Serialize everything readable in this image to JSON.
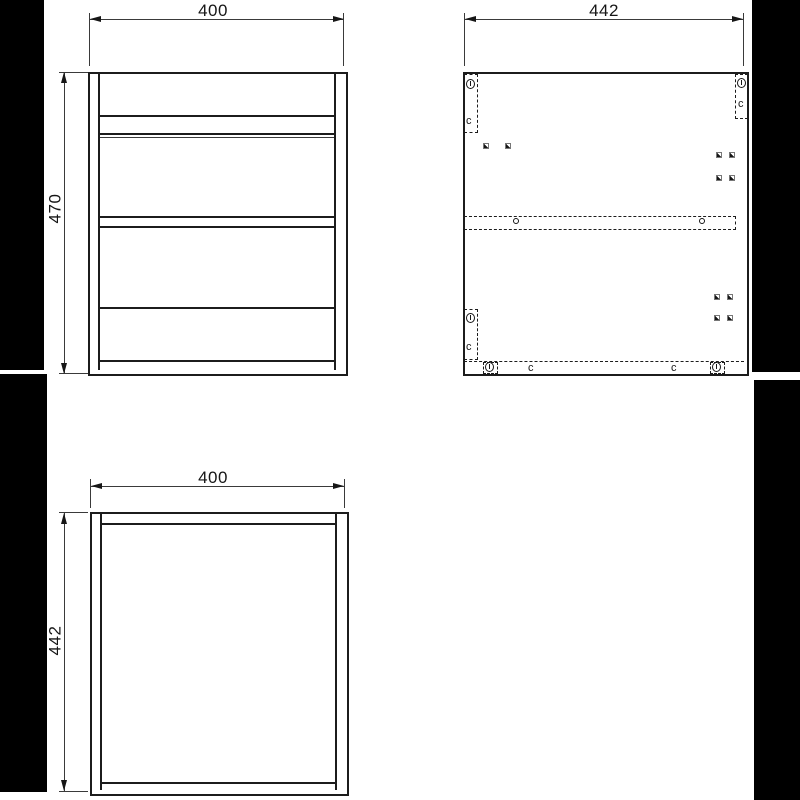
{
  "page": {
    "background": "#ffffff",
    "margin_color": "#000000",
    "line_color": "#1c1c1c"
  },
  "views": {
    "front": {
      "title": "front-view",
      "width_dim": "400",
      "height_dim": "470"
    },
    "side": {
      "title": "side-panel-view",
      "width_dim": "442",
      "cams": [
        {
          "label": "c"
        },
        {
          "label": "c"
        },
        {
          "label": "c"
        },
        {
          "label": "c"
        },
        {
          "label": "c"
        }
      ]
    },
    "top": {
      "title": "top-view",
      "width_dim": "400",
      "depth_dim": "442"
    }
  }
}
